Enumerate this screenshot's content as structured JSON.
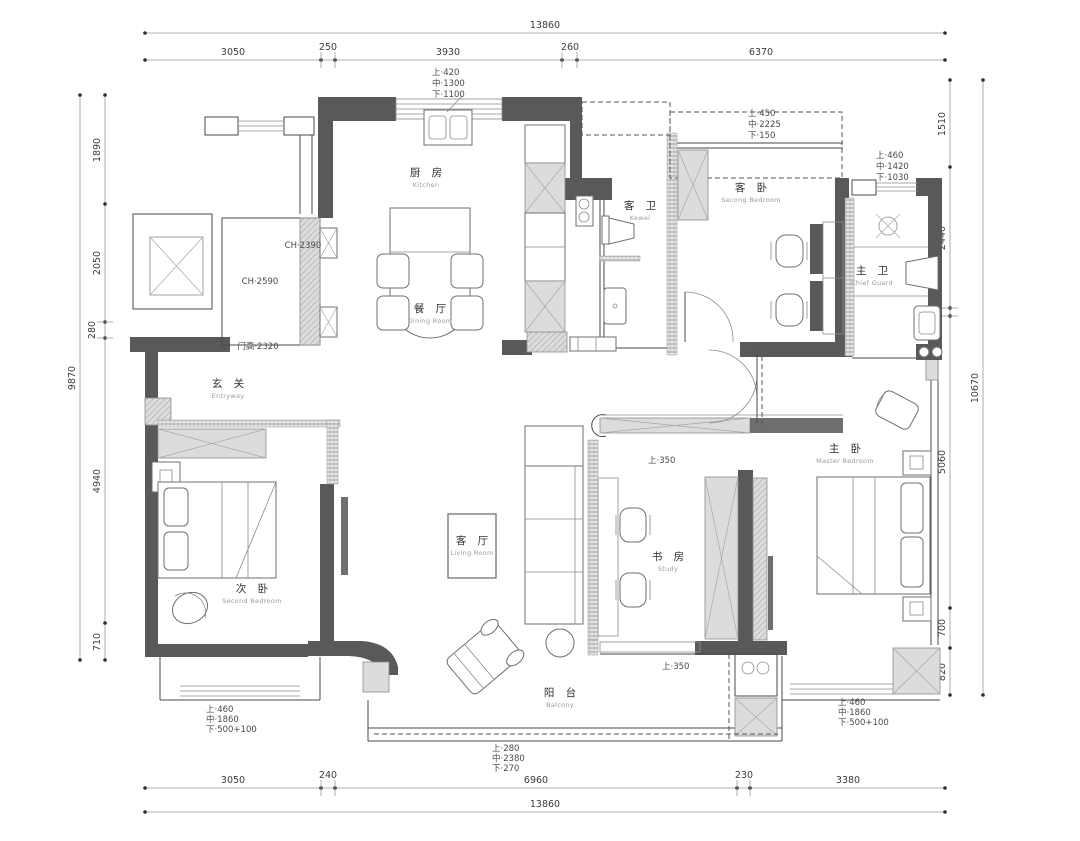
{
  "dims": {
    "top_total": "13860",
    "top": [
      "3050",
      "250",
      "3930",
      "260",
      "6370"
    ],
    "bottom": [
      "3050",
      "240",
      "6960",
      "230",
      "3380"
    ],
    "bottom_total": "13860",
    "left_total": "9870",
    "left": [
      "1890",
      "2050",
      "280",
      "4940",
      "710"
    ],
    "right_total": "10670",
    "right": [
      "1510",
      "2440",
      "140",
      "5060",
      "700",
      "820"
    ]
  },
  "rooms": {
    "kitchen": {
      "zh": "厨 房",
      "en": "Kitchen"
    },
    "dining": {
      "zh": "餐 厅",
      "en": "Dining Room"
    },
    "entry": {
      "zh": "玄 关",
      "en": "Entryway"
    },
    "guest_bath": {
      "zh": "客 卫",
      "en": "Kewei"
    },
    "guest_bedroom": {
      "zh": "客 卧",
      "en": "Secong Bedroom"
    },
    "master_bath": {
      "zh": "主 卫",
      "en": "Chief Guard"
    },
    "second_bedroom": {
      "zh": "次 卧",
      "en": "Second Bedroom"
    },
    "living": {
      "zh": "客 厅",
      "en": "Living Room"
    },
    "study": {
      "zh": "书 房",
      "en": "Study"
    },
    "master_bedroom": {
      "zh": "主 卧",
      "en": "Master Bedroom"
    },
    "balcony": {
      "zh": "阳 台",
      "en": "Balcony"
    }
  },
  "annotations": {
    "win_kitchen": [
      "上·420",
      "中·1300",
      "下·1100"
    ],
    "win_guest_bedroom": [
      "上·450",
      "中·2225",
      "下·150"
    ],
    "win_master_bath": [
      "上·460",
      "中·1420",
      "下·1030"
    ],
    "win_second_bedroom": [
      "上·460",
      "中·1860",
      "下·500+100"
    ],
    "win_master_bedroom": [
      "上·460",
      "中·1860",
      "下·500+100"
    ],
    "win_balcony": [
      "上·280",
      "中·2380",
      "下·270"
    ],
    "beam_study_top": "上·350",
    "beam_study_bottom": "上·350",
    "ch_hall": "CH·2390",
    "ch_storage": "CH·2590",
    "door_height": "门高·2320"
  },
  "colors": {
    "wall": "#595959",
    "hatch": "#dcdcdc",
    "dimension_line": "#9a9a9a"
  }
}
